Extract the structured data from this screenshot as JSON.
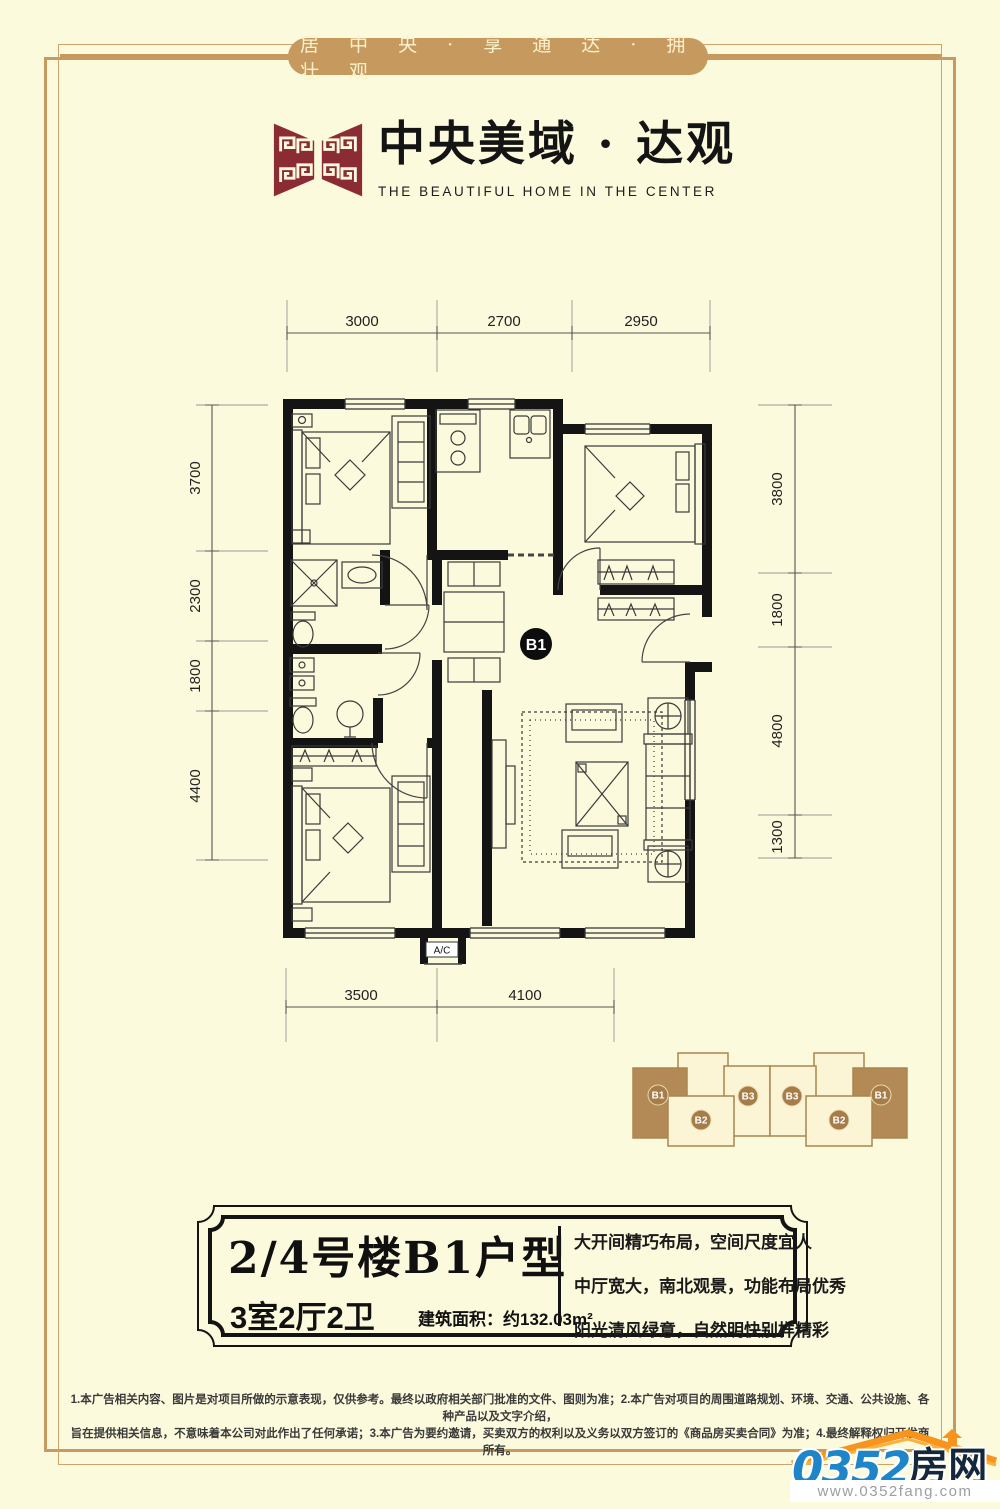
{
  "banner": {
    "text": "居 中 央 · 享 通 达 · 拥 壮 观"
  },
  "brand": {
    "cn": "中央美域 · 达观",
    "en": "THE BEAUTIFUL HOME IN THE CENTER"
  },
  "floor_plan": {
    "unit_badge": "B1",
    "ac_label": "A/C",
    "dims_top": [
      "3000",
      "2700",
      "2950"
    ],
    "dims_left": [
      "3700",
      "2300",
      "1800",
      "4400"
    ],
    "dims_right": [
      "3800",
      "1800",
      "4800",
      "1300"
    ],
    "dims_bottom": [
      "3500",
      "4100"
    ]
  },
  "key_plan": {
    "units": [
      "B1",
      "B2",
      "B3",
      "B3",
      "B2",
      "B1"
    ]
  },
  "info": {
    "title": "2/4号楼B1户型",
    "rooms": "3室2厅2卫",
    "area_label": "建筑面积：",
    "area_value": "约132.03m²",
    "features": [
      "大开间精巧布局，空间尺度宜人",
      "中厅宽大，南北观景，功能布局优秀",
      "阳光清风绿意，自然明快别样精彩"
    ]
  },
  "disclaimer": {
    "line1": "1.本广告相关内容、图片是对项目所做的示意表现，仅供参考。最终以政府相关部门批准的文件、图则为准；2.本广告对项目的周围道路规划、环境、交通、公共设施、各种产品以及文字介绍，",
    "line2": "旨在提供相关信息，不意味着本公司对此作出了任何承诺；3.本广告为要约邀请，买卖双方的权利以及义务以双方签订的《商品房买卖合同》为准；4.最终解释权归开发商所有。"
  },
  "site": {
    "number": "0352",
    "name": "房网",
    "url": "www.0352fang.com"
  },
  "colors": {
    "accent_tan": "#C6995F",
    "brand_maroon": "#8B2B34",
    "highlight_brown": "#B38A55",
    "site_blue": "#1E86C8",
    "site_orange": "#F7941D"
  }
}
